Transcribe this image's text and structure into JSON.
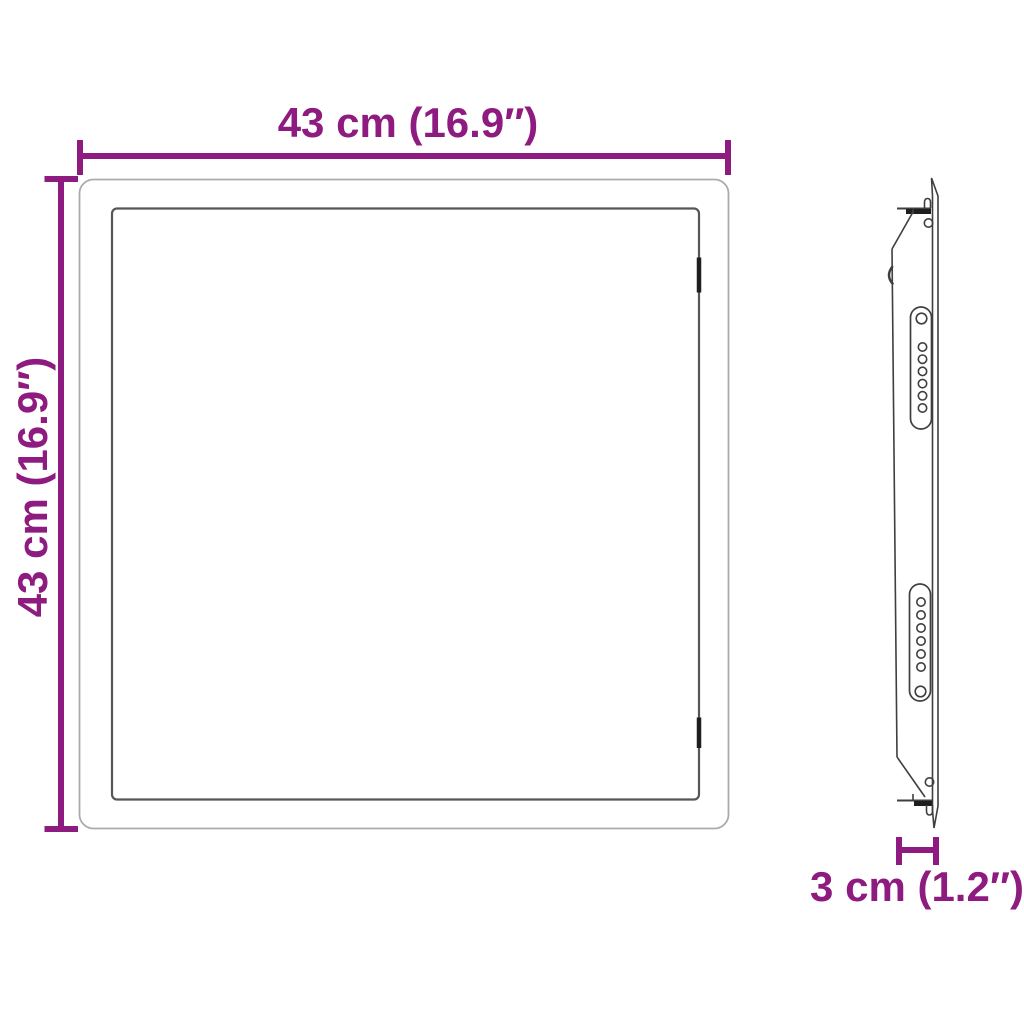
{
  "diagram": {
    "kind": "product-dimension-diagram",
    "views": [
      {
        "id": "front",
        "description": "front view of square panel with inner frame and two hinge marks on right edge"
      },
      {
        "id": "side",
        "description": "side profile with mounting flanges, two slotted brackets and screw holes"
      }
    ],
    "dimensions": [
      {
        "id": "width",
        "label": "43 cm (16.9″)",
        "orientation": "horizontal",
        "position": "top"
      },
      {
        "id": "height",
        "label": "43 cm (16.9″)",
        "orientation": "vertical",
        "position": "left"
      },
      {
        "id": "depth",
        "label": "3 cm (1.2″)",
        "orientation": "horizontal",
        "position": "bottom-right"
      }
    ]
  },
  "colors": {
    "dimension_accent": "#8e1b7f",
    "outline_light": "#ababab",
    "outline_mid": "#565656",
    "outline_dark": "#1e1e1e",
    "background": "#ffffff"
  }
}
